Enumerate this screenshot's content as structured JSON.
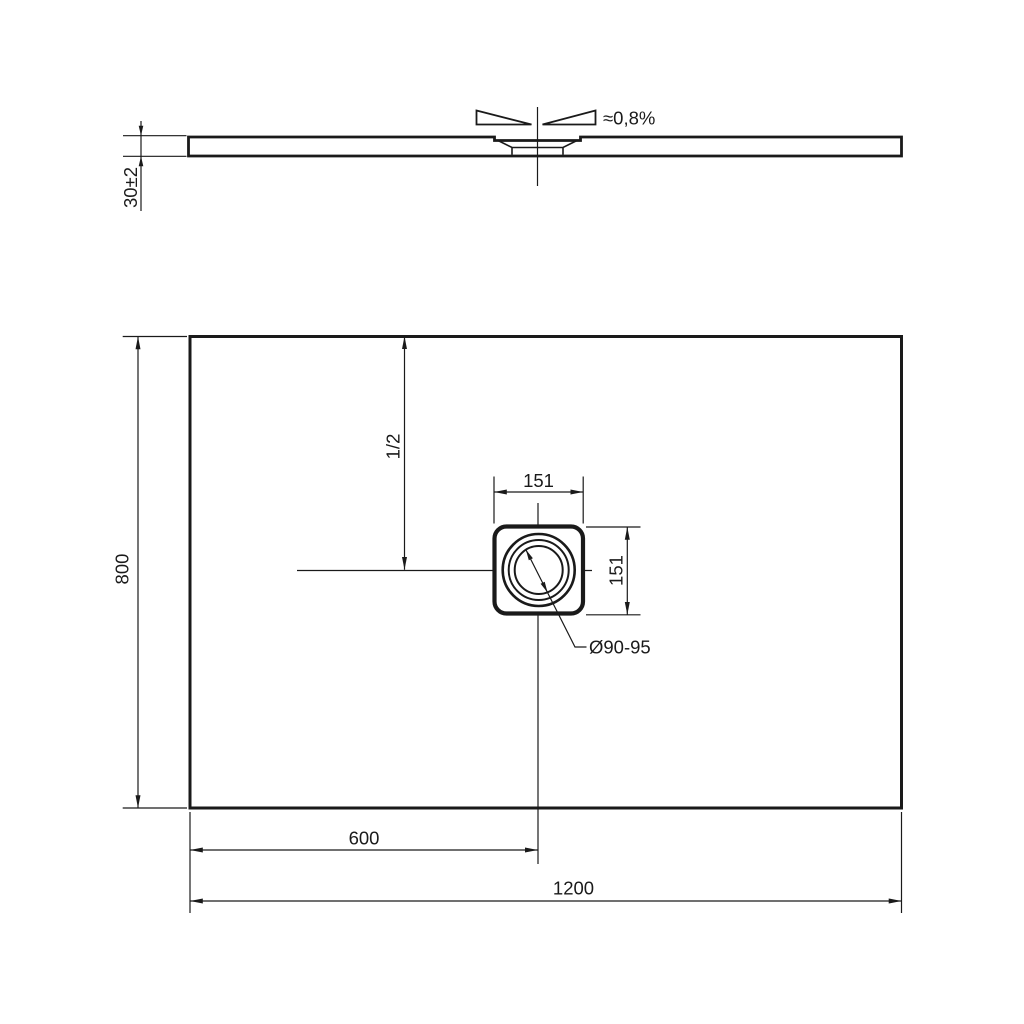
{
  "colors": {
    "ink": "#1a1a1a",
    "paper": "#ffffff"
  },
  "side_view": {
    "thickness_dim": "30±2",
    "slope_label": "≈0,8%"
  },
  "plan_view": {
    "length_dim": "1200",
    "depth_dim": "800",
    "drain_offset_dim": "600",
    "centre_dim": "1/2",
    "drain_square_width_dim": "151",
    "drain_square_depth_dim": "151",
    "drain_diameter_label": "Ø90-95"
  }
}
